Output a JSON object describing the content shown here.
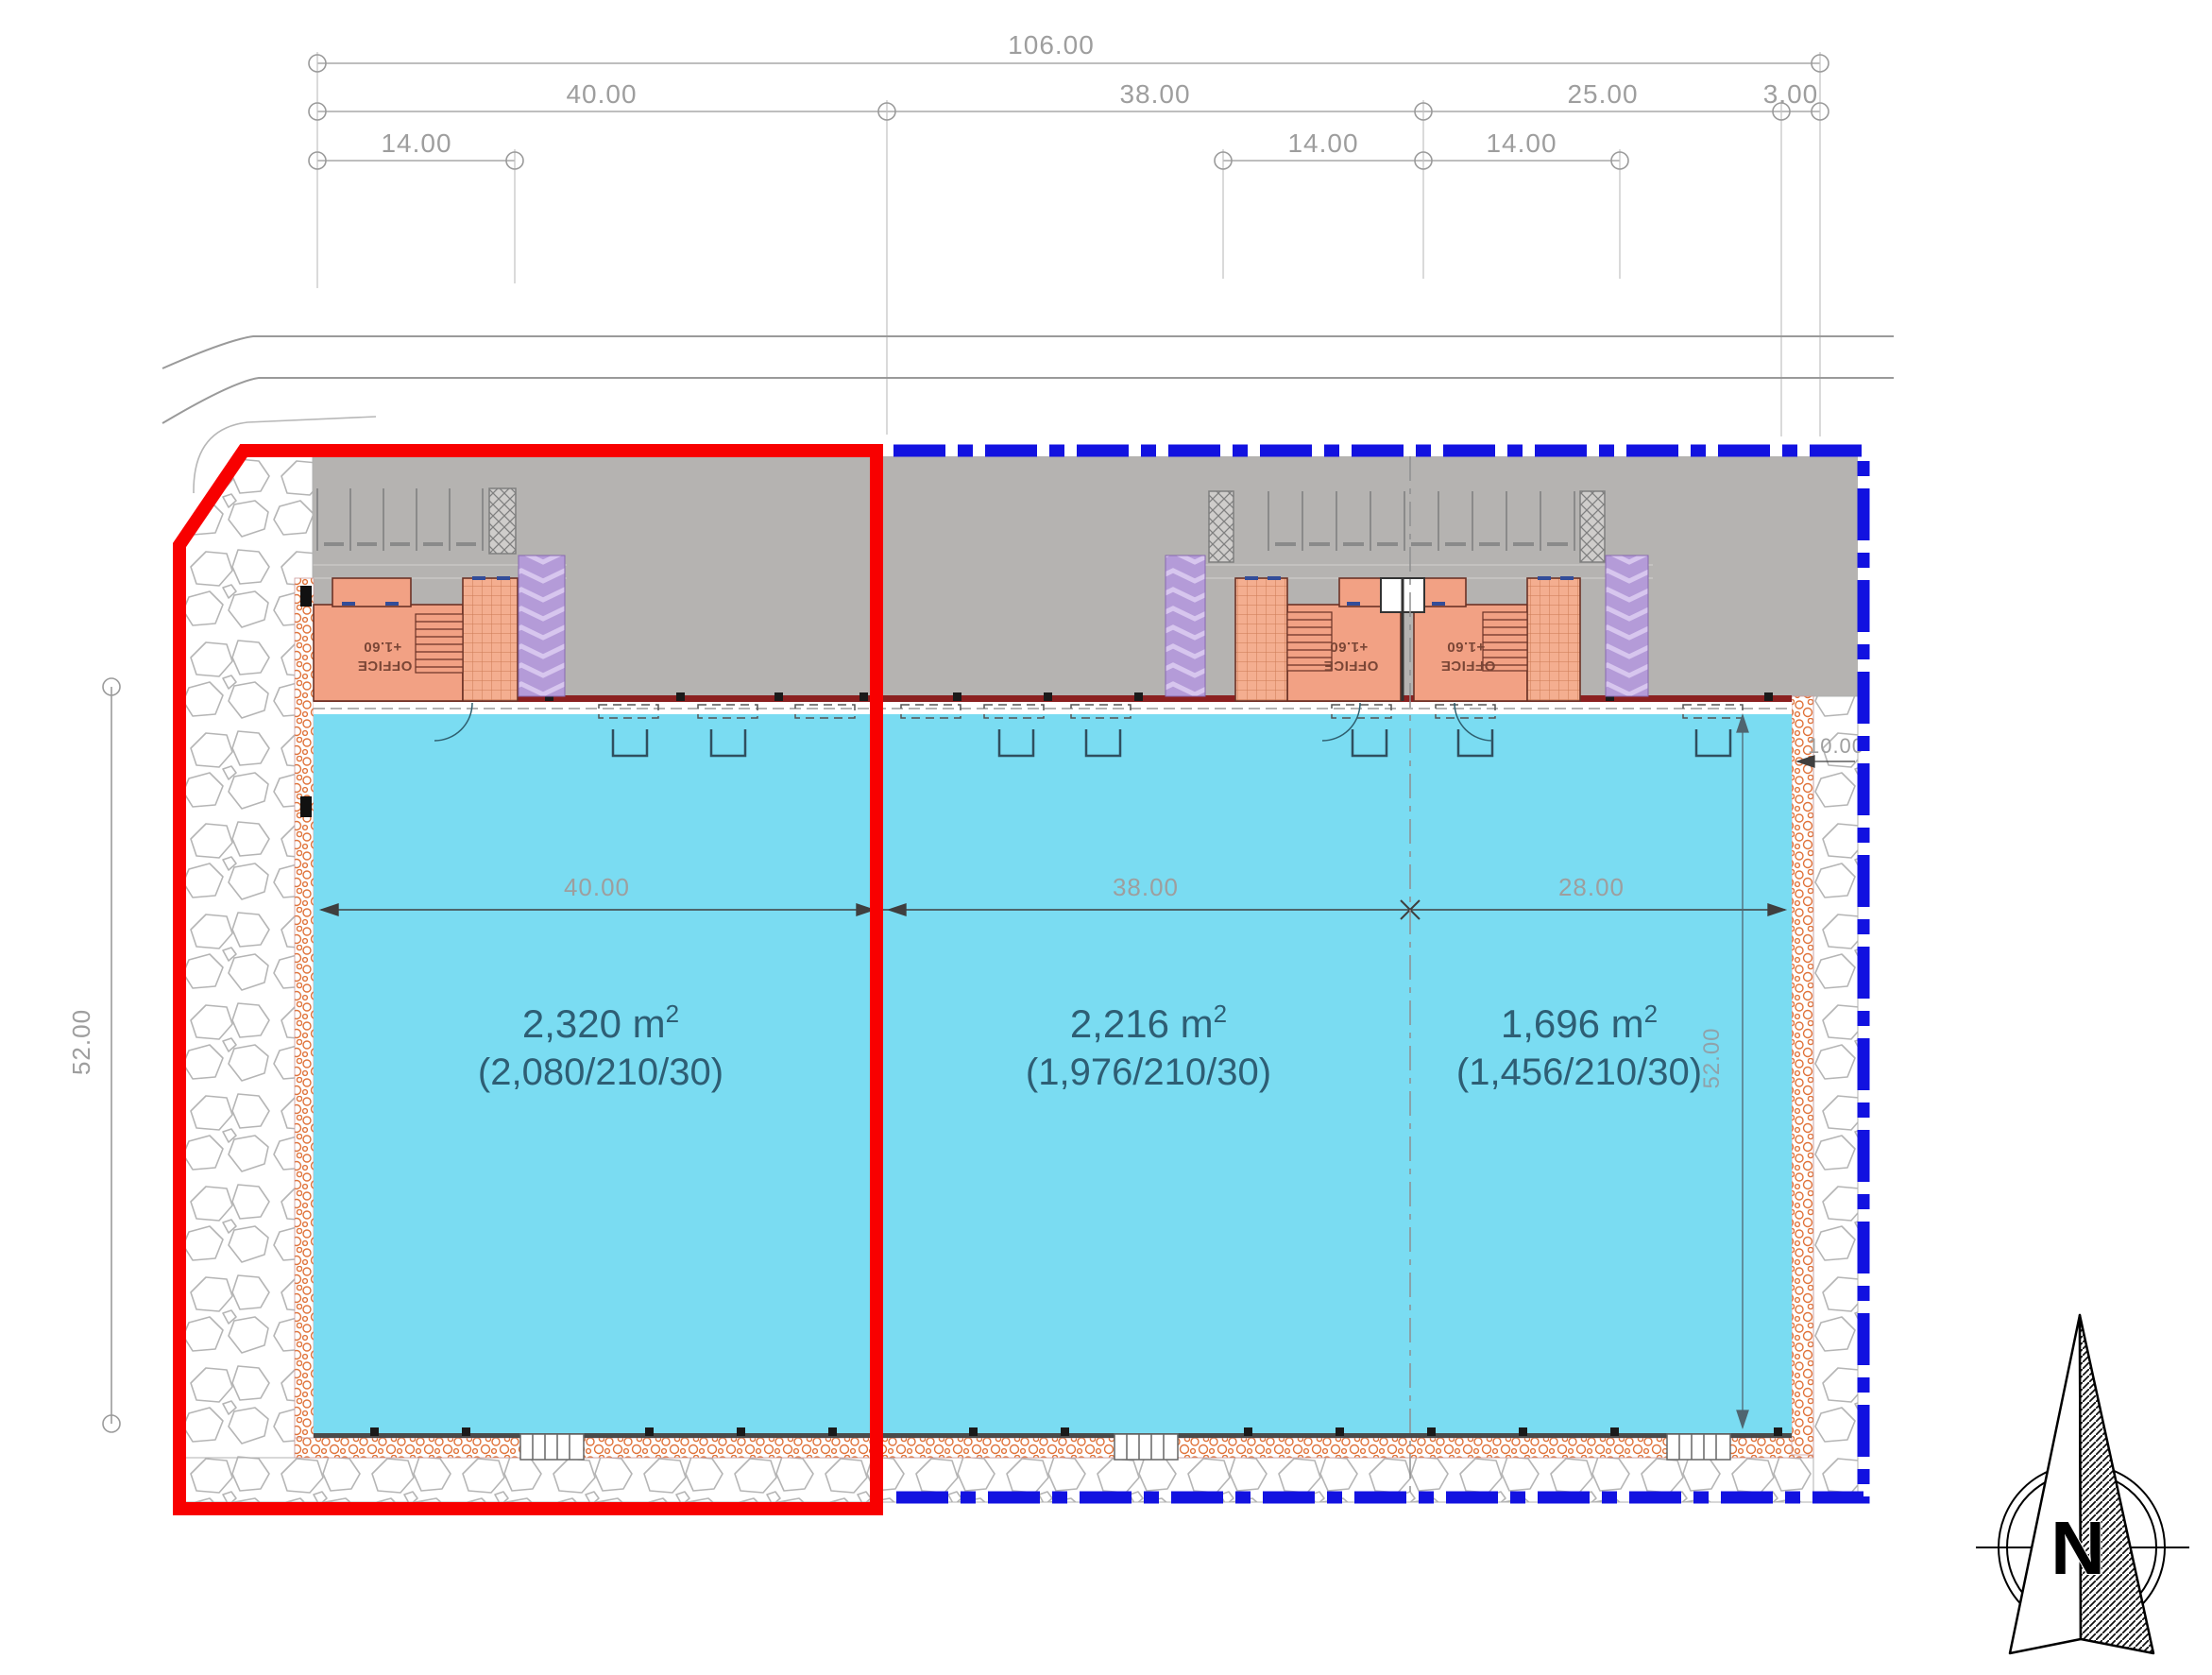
{
  "dims": {
    "overall": "106.00",
    "row2": [
      "40.00",
      "38.00",
      "25.00",
      "3.00"
    ],
    "row3": [
      "14.00",
      "14.00",
      "14.00"
    ],
    "interior": [
      "40.00",
      "38.00",
      "28.00"
    ],
    "height_left": "52.00",
    "height_right": "52.00",
    "offset_right": "10.00"
  },
  "units": [
    {
      "area": "2,320 m",
      "area_sup": "2",
      "program": "(2,080/210/30)"
    },
    {
      "area": "2,216 m",
      "area_sup": "2",
      "program": "(1,976/210/30)"
    },
    {
      "area": "1,696 m",
      "area_sup": "2",
      "program": "(1,456/210/30)"
    }
  ],
  "offices": [
    {
      "label": "OFFICE",
      "level": "+1.60"
    },
    {
      "label": "OFFICE",
      "level": "+1.60"
    },
    {
      "label": "OFFICE",
      "level": "+1.60"
    }
  ],
  "compass": {
    "north": "N"
  },
  "colors": {
    "parcel_red": "#f80000",
    "parcel_blue": "#1212e0",
    "hall_cyan": "#7adcf2",
    "office_salmon": "#f2a184",
    "ramp_purple": "#b49bd8",
    "paving_gray": "#b5b3b1",
    "label_teal": "#2e5e74",
    "dim_gray": "#9e9e9e"
  }
}
